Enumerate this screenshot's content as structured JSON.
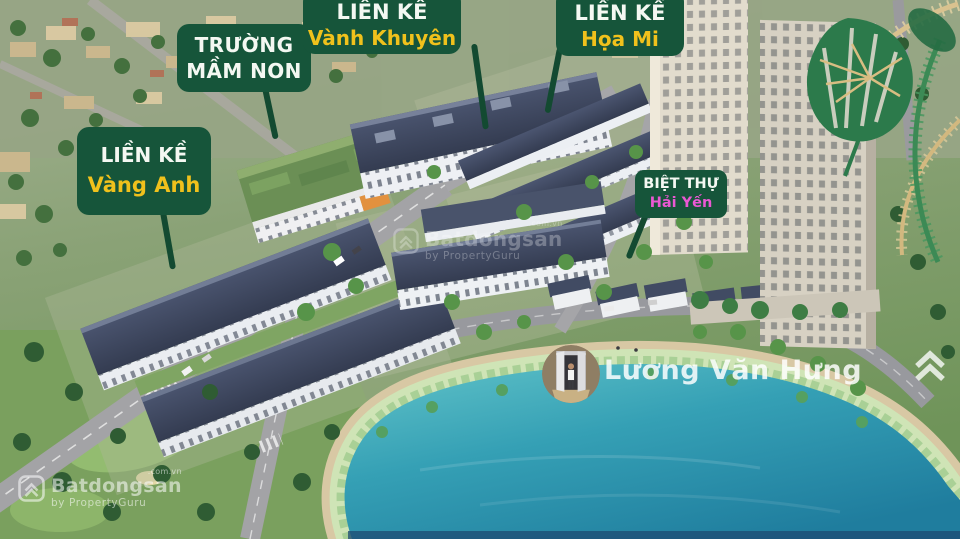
{
  "callouts": {
    "truong_mam_non": {
      "line1": "TRƯỜNG",
      "line2": "MẦM NON"
    },
    "lien_ke_vanh_khuyen": {
      "line1": "LIỀN KỀ",
      "line2": "Vành Khuyên"
    },
    "lien_ke_hoa_mi": {
      "line1": "LIỀN KỀ",
      "line2": "Họa Mi"
    },
    "lien_ke_vang_anh": {
      "line1": "LIỀN KỀ",
      "line2": "Vàng Anh"
    },
    "biet_thu_hai_yen": {
      "line1": "BIỆT THỰ",
      "line2": "Hải Yến"
    }
  },
  "watermarks": {
    "agent_name": "Lương Văn Hưng",
    "brand_name": "Batdongsan",
    "brand_domain": ".com.vn",
    "brand_byline": "by PropertyGuru"
  },
  "icons": {
    "brand_logo": "double-chevron-house-icon",
    "agent_avatar": "agent-photo-avatar"
  },
  "colors": {
    "label-bg": "#16553a",
    "label-text": "#f4f8f2",
    "accent-yellow": "#f0c11c",
    "accent-pink": "#ea58d3",
    "pointer": "#134a31",
    "water": "#2f9ab0"
  }
}
